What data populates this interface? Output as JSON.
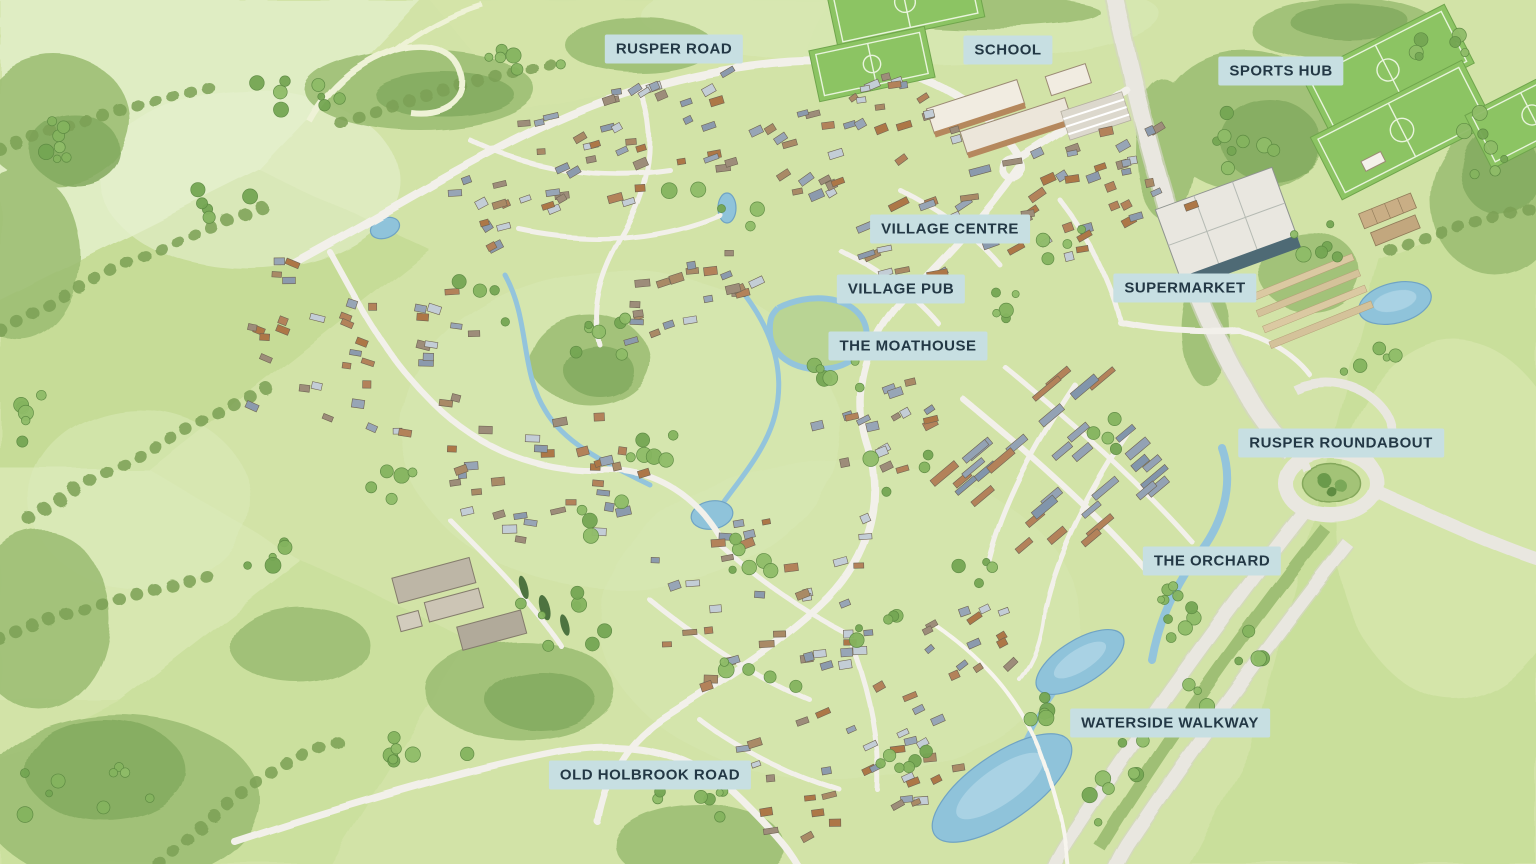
{
  "map": {
    "kind": "illustrated-masterplan-aerial-watercolour",
    "labels": [
      {
        "id": "rusper-road",
        "text": "RUSPER ROAD",
        "x": 674,
        "y": 49
      },
      {
        "id": "school",
        "text": "SCHOOL",
        "x": 1008,
        "y": 50
      },
      {
        "id": "sports-hub",
        "text": "SPORTS HUB",
        "x": 1281,
        "y": 71
      },
      {
        "id": "village-centre",
        "text": "VILLAGE CENTRE",
        "x": 950,
        "y": 229
      },
      {
        "id": "village-pub",
        "text": "VILLAGE PUB",
        "x": 901,
        "y": 289
      },
      {
        "id": "supermarket",
        "text": "SUPERMARKET",
        "x": 1185,
        "y": 288
      },
      {
        "id": "the-moathouse",
        "text": "THE MOATHOUSE",
        "x": 908,
        "y": 346
      },
      {
        "id": "rusper-roundabout",
        "text": "RUSPER ROUNDABOUT",
        "x": 1341,
        "y": 443
      },
      {
        "id": "the-orchard",
        "text": "THE ORCHARD",
        "x": 1212,
        "y": 561
      },
      {
        "id": "waterside-walkway",
        "text": "WATERSIDE WALKWAY",
        "x": 1170,
        "y": 723
      },
      {
        "id": "old-holbrook-road",
        "text": "OLD HOLBROOK ROAD",
        "x": 650,
        "y": 775
      }
    ],
    "palette": {
      "label_background": "#c7dfe2",
      "label_text": "#233845",
      "field_green": "#d2e3a7",
      "woodland_green": "#83aa5e",
      "pitch_green": "#8cc463",
      "water_blue": "#8fc3da",
      "road_white": "#efede6",
      "house_roof_grey": "#93a2b4",
      "house_wall_orange": "#b3825a",
      "supermarket_wall_teal": "#4e6a75"
    }
  },
  "labels": [
    {
      "id": "rusper-road",
      "text": "RUSPER ROAD",
      "x": 674,
      "y": 49
    },
    {
      "id": "school",
      "text": "SCHOOL",
      "x": 1008,
      "y": 50
    },
    {
      "id": "sports-hub",
      "text": "SPORTS HUB",
      "x": 1281,
      "y": 71
    },
    {
      "id": "village-centre",
      "text": "VILLAGE CENTRE",
      "x": 950,
      "y": 229
    },
    {
      "id": "village-pub",
      "text": "VILLAGE PUB",
      "x": 901,
      "y": 289
    },
    {
      "id": "supermarket",
      "text": "SUPERMARKET",
      "x": 1185,
      "y": 288
    },
    {
      "id": "the-moathouse",
      "text": "THE MOATHOUSE",
      "x": 908,
      "y": 346
    },
    {
      "id": "rusper-roundabout",
      "text": "RUSPER ROUNDABOUT",
      "x": 1341,
      "y": 443
    },
    {
      "id": "the-orchard",
      "text": "THE ORCHARD",
      "x": 1212,
      "y": 561
    },
    {
      "id": "waterside-walkway",
      "text": "WATERSIDE WALKWAY",
      "x": 1170,
      "y": 723
    },
    {
      "id": "old-holbrook-road",
      "text": "OLD HOLBROOK ROAD",
      "x": 650,
      "y": 775
    }
  ]
}
